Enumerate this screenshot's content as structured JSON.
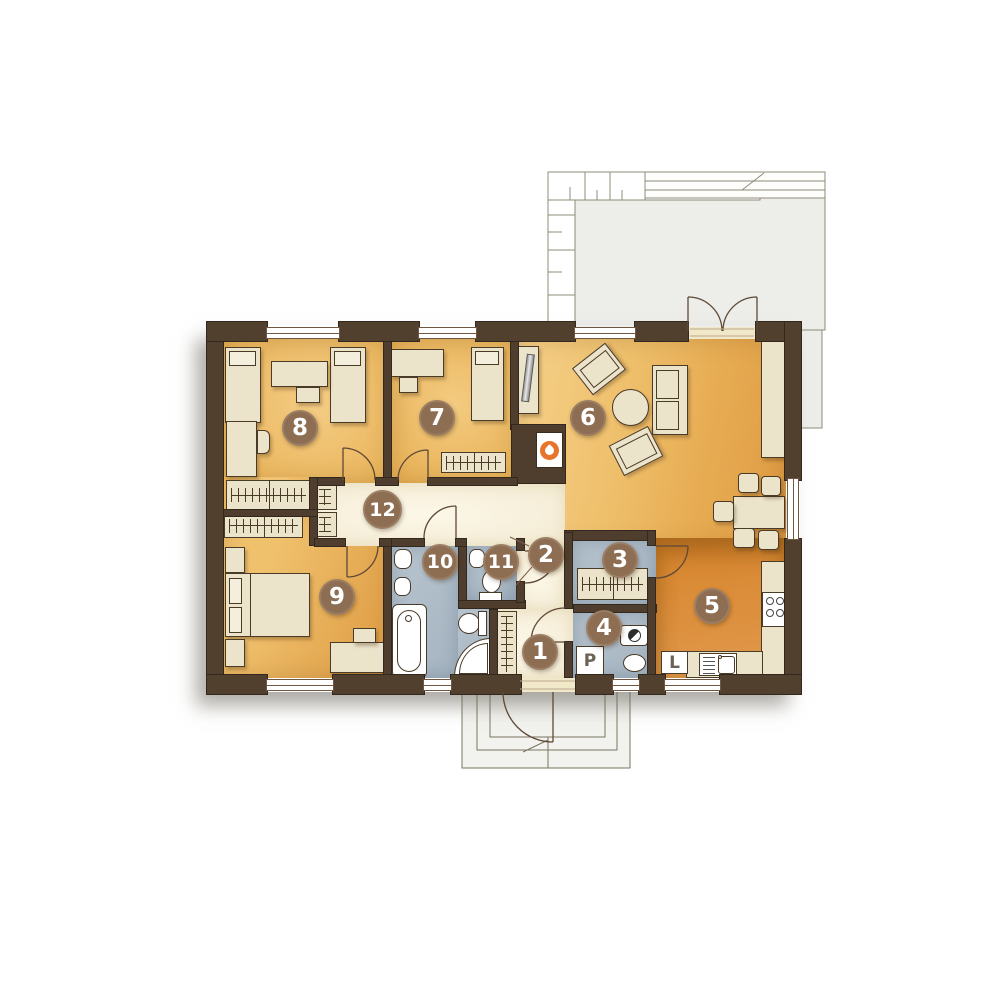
{
  "floorplan": {
    "room_badges": [
      "1",
      "2",
      "3",
      "4",
      "5",
      "6",
      "7",
      "8",
      "9",
      "10",
      "11",
      "12"
    ],
    "appliance_labels": {
      "washing_machine": "P",
      "fridge": "L"
    },
    "colors": {
      "wall": "#52402e",
      "bedroom_floor": "#efc06c",
      "living_floor": "#eebb62",
      "kitchen_floor": "#d98a33",
      "bathroom_floor": "#adbcc8",
      "hallway_floor": "#f7f0da",
      "furniture": "#ece3cb",
      "terrace": "#ededea",
      "badge": "#8d6e53",
      "flame_accent": "#e8742c"
    }
  }
}
